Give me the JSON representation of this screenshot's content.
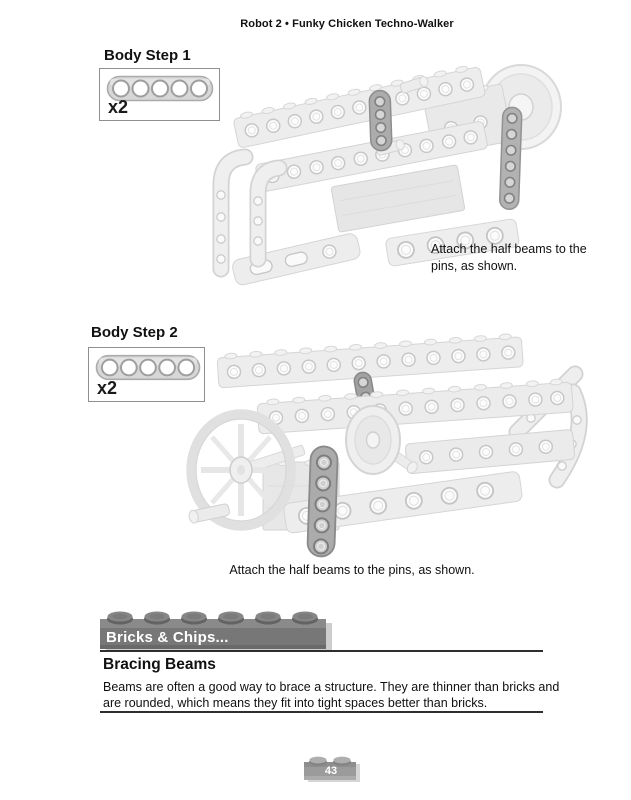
{
  "page": {
    "header": "Robot 2 • Funky Chicken Techno-Walker",
    "page_number": "43"
  },
  "steps": [
    {
      "title": "Body Step 1",
      "quantity": "x2",
      "part_name": "half-beam-5-hole",
      "caption": "Attach the half beams to the pins, as shown."
    },
    {
      "title": "Body Step 2",
      "quantity": "x2",
      "part_name": "half-beam-5-hole",
      "caption": "Attach the half beams to the pins, as shown."
    }
  ],
  "callout": {
    "banner": "Bricks & Chips...",
    "heading": "Bracing Beams",
    "body": "Beams are often a good way to brace a structure. They are thinner than bricks and are rounded, which means they fit into tight spaces better than bricks."
  },
  "colors": {
    "part_light": "#ededed",
    "part_outline": "#d4d4d4",
    "highlight_part": "#acacac",
    "banner_brick": "#777777",
    "text": "#111111",
    "rule": "#2e2e2e"
  }
}
